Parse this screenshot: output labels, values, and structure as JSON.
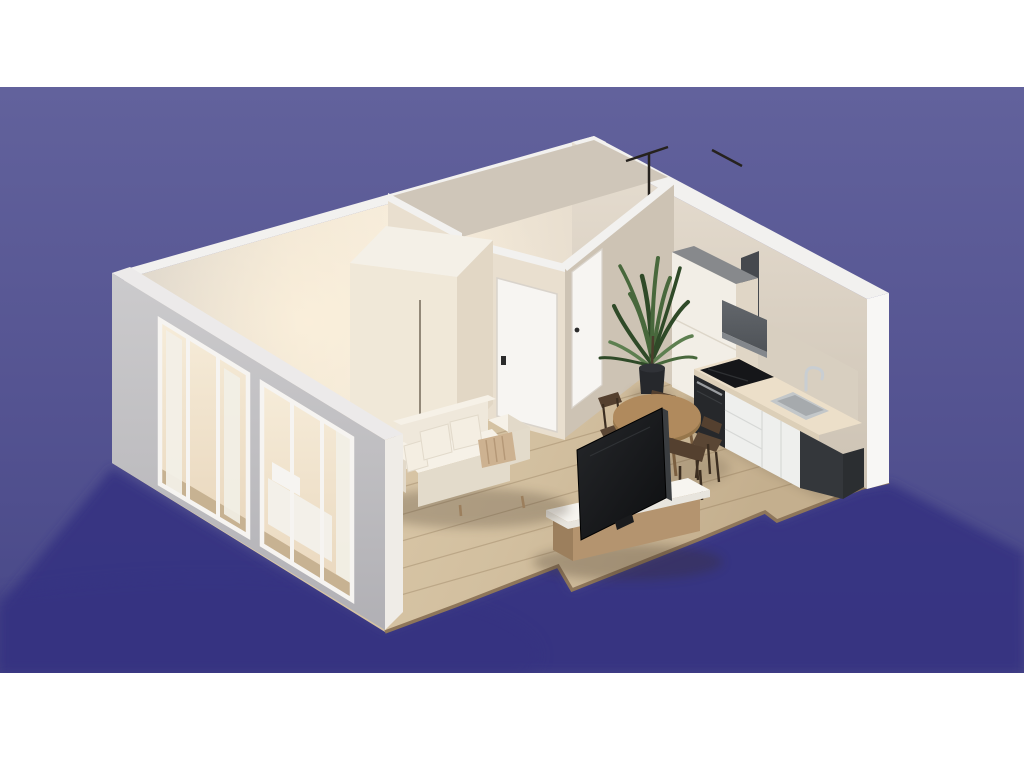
{
  "scene": {
    "title": "3D isometric cutaway render of a studio apartment floor plan",
    "rooms": [
      {
        "name": "bathroom",
        "features": [
          "shower-rail",
          "towel-bar"
        ]
      },
      {
        "name": "bedroom",
        "features": [
          "wardrobe",
          "bed",
          "curtains",
          "window-wall"
        ]
      },
      {
        "name": "hallway",
        "features": [
          "interior-door",
          "interior-door"
        ]
      },
      {
        "name": "living-room",
        "features": [
          "sofa",
          "tv",
          "tv-bench"
        ]
      },
      {
        "name": "kitchen-dining",
        "features": [
          "tall-cabinet",
          "range-hood",
          "cooktop",
          "oven",
          "sink",
          "dining-table",
          "four-chairs",
          "plant"
        ]
      }
    ],
    "furniture_counts": {
      "doors": 2,
      "sofa_pillows": 4,
      "dining_chairs": 4,
      "window_openings": 2
    }
  },
  "palette": {
    "band": "#ffffff",
    "bg-top": "#62629c",
    "bg-bottom": "#474787",
    "ground-shadow": "#343381",
    "wall-top": "#f2f1ef",
    "wall-end": "#f8f7f5",
    "wall-right-hi": "#e3dacc",
    "wall-right-lo": "#cfc5b6",
    "backsplash": "#d8cfc0",
    "facade-top": "#eceaea",
    "facade-end": "#efece7",
    "wood-hi": "#dbc9ab",
    "wood-lo": "#c7b292",
    "wood-edge": "#8e765a",
    "plank": "#7d6445",
    "glow-hi": "#f6ecd9",
    "glow-lo": "#ead9c0",
    "curtain": "#f2efe7",
    "frame": "#f6f4f1",
    "bed": "#f3f0e9",
    "partition-lit": "#e9dfcf",
    "partition-shade": "#cdc3b4",
    "bath-inner": "#cfc6b9",
    "rail": "#26221e",
    "door": "#f7f5f2",
    "door-stroke": "#d9d3cb",
    "handle": "#2b2b2b",
    "wardrobe": "#f0e8d8",
    "wardrobe-side": "#e2d7c5",
    "wardrobe-top": "#f4f0e7",
    "wardrobe-handle": "#7a7061",
    "fridge": "#f2eee6",
    "fridge-side": "#e0d6c6",
    "fridge-top": "#87898c",
    "chimney": "#46494e",
    "hood": "#565a5f",
    "hood-lip": "#83878c",
    "counter": "#ecdfc9",
    "counter-edge": "#dccfb8",
    "cooktop": "#151619",
    "oven": "#26282b",
    "oven-handle": "#9a9da0",
    "cabinet": "#eeefed",
    "cabinet-seam": "#d6d8d6",
    "endpanel": "#34373b",
    "endpanel-side": "#2b2e31",
    "sink": "#c3c7c9",
    "sink-inner": "#a6aaad",
    "faucet": "#c9ced2",
    "pot": "#26282c",
    "trunk": "#4b3d2c",
    "leaf1": "#2f4a28",
    "leaf2": "#48683c",
    "leaf3": "#5d7f50",
    "table": "#b08a5d",
    "table-rim": "#96764b",
    "table-leg": "#7b5f40",
    "chair": "#54402f",
    "chair-mid": "#5a4634",
    "chair-dark": "#3c2e21",
    "bench-wood": "#b4946f",
    "bench-wood-dark": "#9c7f5d",
    "bench-wood-top": "#c4a67e",
    "shelf": "#f7f5f0",
    "shelf-edge": "#e8e5de",
    "tv": "#1a1c1e",
    "tv-edge": "#3b3e41",
    "sofa": "#efe8db",
    "sofa-top": "#f6f1e7",
    "sofa-shade": "#e3dbcb",
    "sofa-arm-shade": "#e2d9c9",
    "pillow": "#f4eee2",
    "pillow-accent": "#cdb291",
    "pillow-accent-line": "#b59877",
    "foot": "#9c7f5d"
  }
}
